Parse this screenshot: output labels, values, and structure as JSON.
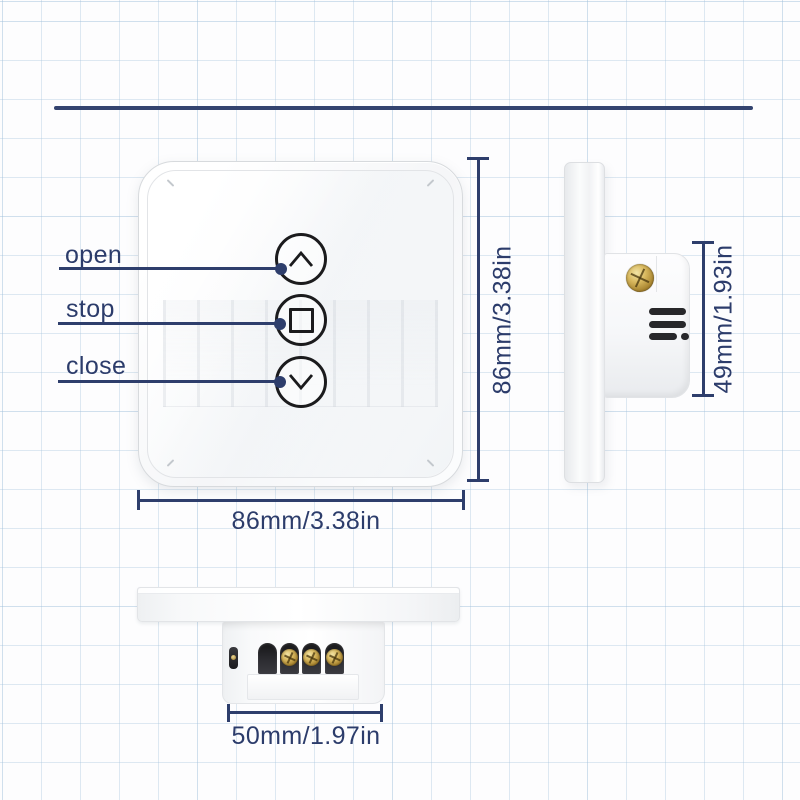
{
  "diagram": {
    "type": "product-dimension-diagram",
    "subject": "smart curtain touch switch"
  },
  "front_view": {
    "labels": [
      {
        "text": "open",
        "icon": "chevron-up"
      },
      {
        "text": "stop",
        "icon": "stop-square"
      },
      {
        "text": "close",
        "icon": "chevron-down"
      }
    ],
    "width_dim": "86mm/3.38in",
    "height_dim": "86mm/3.38in"
  },
  "side_view": {
    "depth_dim": "49mm/1.93in",
    "vent_slot_count": 3,
    "screw_count": 1
  },
  "bottom_view": {
    "module_width_dim": "50mm/1.97in",
    "terminal_count": 4
  },
  "icons": {
    "chevron-up": "^ chevron drawn as SVG polyline",
    "stop-square": "square outline (CSS border)",
    "chevron-down": "v chevron drawn as SVG polyline",
    "terminal-screw": "brass phillips screw (CSS radial gradient)",
    "vent-slot": "dark rounded slot (CSS bar)"
  },
  "colors": {
    "annotation_navy": "#2e3e6c",
    "button_outline": "#1b1b1d",
    "brass_screw": "#c9a44e",
    "vent_dark": "#27272a",
    "grid_blue": "#a8c5de",
    "background": "#fdfdfe"
  }
}
